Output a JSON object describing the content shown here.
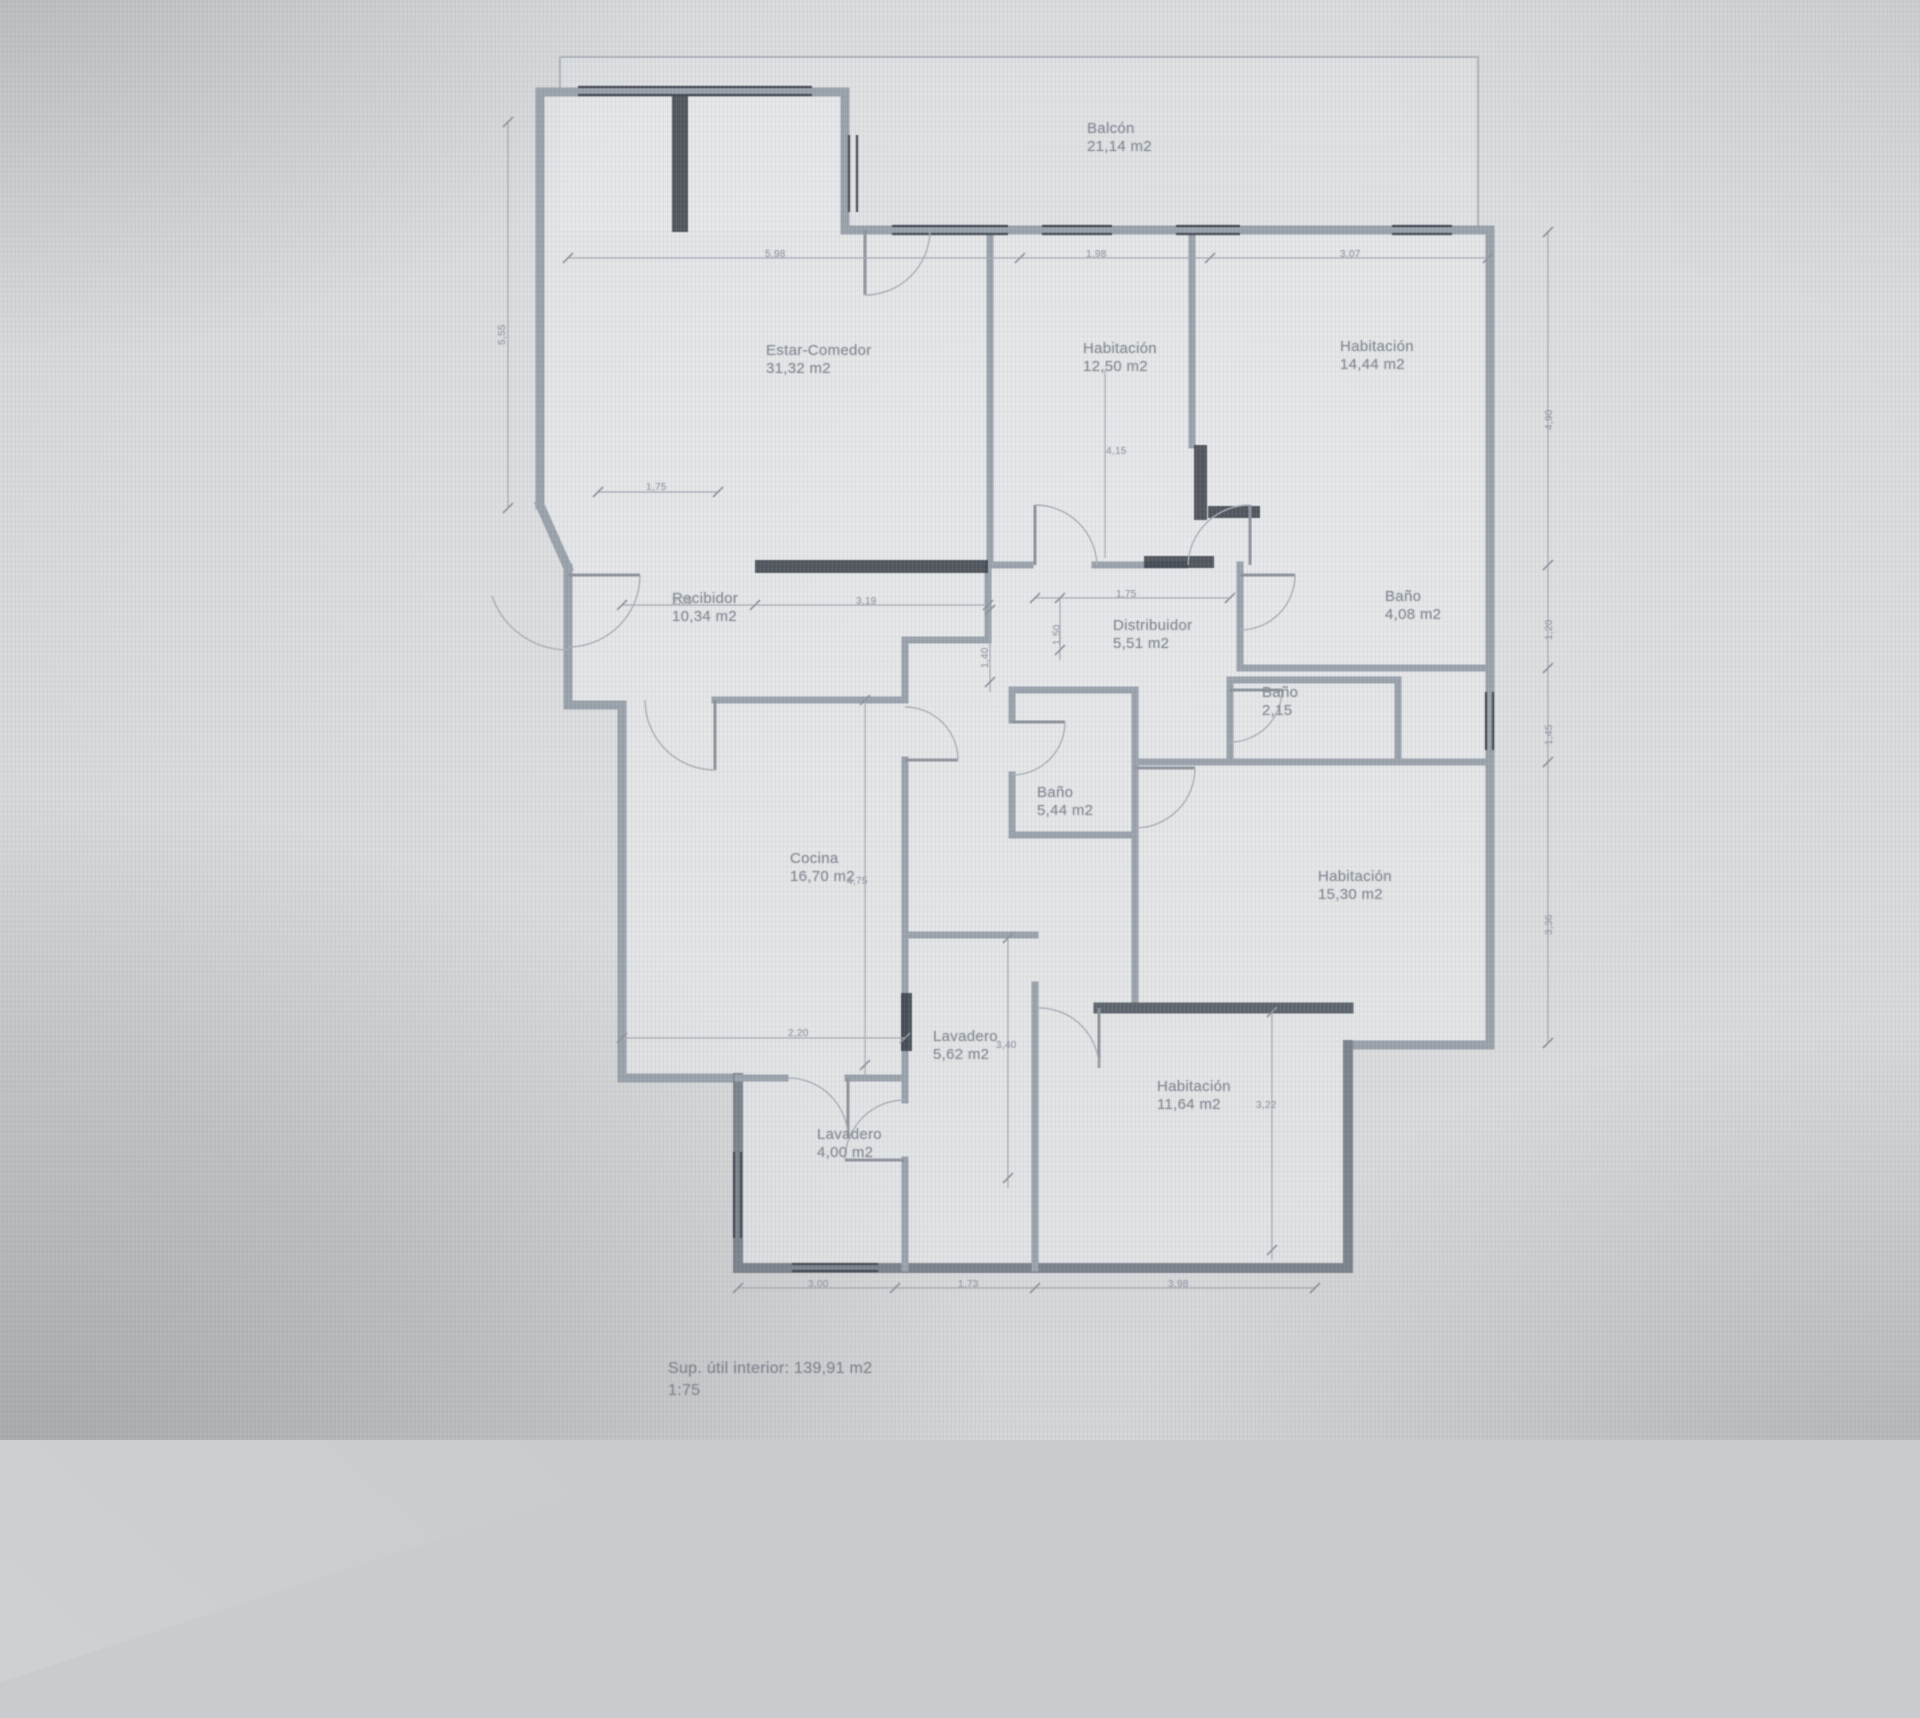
{
  "plan": {
    "title": "floor-plan",
    "area_summary": "Sup. útil interior: 139,91 m2",
    "scale_label": "1:75",
    "colors": {
      "screen_background": "#d8dadc",
      "wall": "#99a1ab",
      "wall_dark": "#5d646d",
      "line": "#a4aab2",
      "window": "#424850",
      "room_text": "#868c95",
      "dim_text": "#979da6"
    },
    "rooms": [
      {
        "id": "balcon",
        "name": "Balcón",
        "area": "21,14 m2"
      },
      {
        "id": "estar-comedor",
        "name": "Estar-Comedor",
        "area": "31,32 m2"
      },
      {
        "id": "habitacion-1",
        "name": "Habitación",
        "area": "12,50 m2"
      },
      {
        "id": "habitacion-2",
        "name": "Habitación",
        "area": "14,44 m2"
      },
      {
        "id": "recibidor",
        "name": "Recibidor",
        "area": "10,34 m2"
      },
      {
        "id": "distribuidor",
        "name": "Distribuidor",
        "area": "5,51 m2"
      },
      {
        "id": "bano-1",
        "name": "Baño",
        "area": "4,08 m2"
      },
      {
        "id": "bano-2",
        "name": "Baño",
        "area": "2,15"
      },
      {
        "id": "bano-3",
        "name": "Baño",
        "area": "5,44 m2"
      },
      {
        "id": "cocina",
        "name": "Cocina",
        "area": "16,70 m2"
      },
      {
        "id": "habitacion-3",
        "name": "Habitación",
        "area": "15,30 m2"
      },
      {
        "id": "lavadero-1",
        "name": "Lavadero",
        "area": "5,62 m2"
      },
      {
        "id": "habitacion-4",
        "name": "Habitación",
        "area": "11,64 m2"
      },
      {
        "id": "lavadero-2",
        "name": "Lavadero",
        "area": "4,00 m2"
      }
    ],
    "dimensions": {
      "top": [
        "5,98",
        "1,98",
        "3,07"
      ],
      "bottom": [
        "3,00",
        "1,73",
        "3,98"
      ],
      "left": [
        "5,55"
      ],
      "right": [
        "4,90",
        "1,20",
        "1,45",
        "3,36"
      ],
      "inner": [
        "1,75",
        "2,35",
        "3,19",
        "1,75",
        "1,40",
        "1,50",
        "4,75",
        "2,20",
        "3,40",
        "3,22",
        "4,15"
      ]
    }
  }
}
